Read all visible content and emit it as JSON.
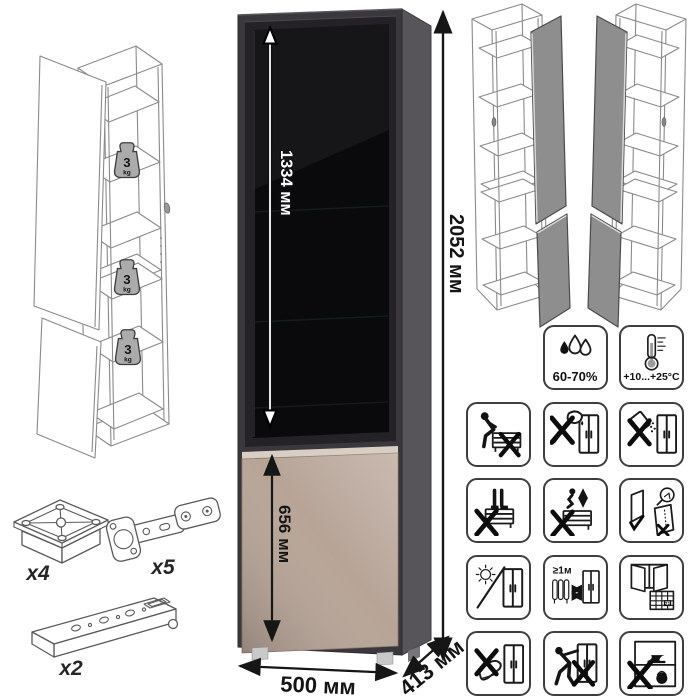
{
  "product": {
    "dimensions": {
      "total_height": "2052 мм",
      "glass_door_height": "1334 мм",
      "lower_door_height": "656 мм",
      "width": "500 мм",
      "depth": "413 мм"
    },
    "shelf_load": {
      "value": "3",
      "unit": "kg"
    }
  },
  "hardware": {
    "foot_glides": "x4",
    "hinges": "x5",
    "mounting_rails": "x2"
  },
  "care": {
    "humidity_range": "60-70%",
    "temperature_range": "+10...+25°C",
    "heater_min_distance": "≥1м",
    "ventilation_calendar_day": "21",
    "icon_names": [
      "humidity",
      "temperature",
      "no-sitting",
      "no-sharp-tools",
      "no-spilling",
      "no-standing",
      "no-jumping",
      "door-adjustment",
      "no-direct-sunlight",
      "heater-distance",
      "ventilation",
      "no-kicking",
      "no-pushing",
      "no-heavy-load"
    ]
  },
  "colors": {
    "cabinet_front": "#3b383d",
    "cabinet_side": "#57545a",
    "glass_door": "#0a090c",
    "lower_door_top": "#d9cec3",
    "lower_door": "#b7a497"
  }
}
